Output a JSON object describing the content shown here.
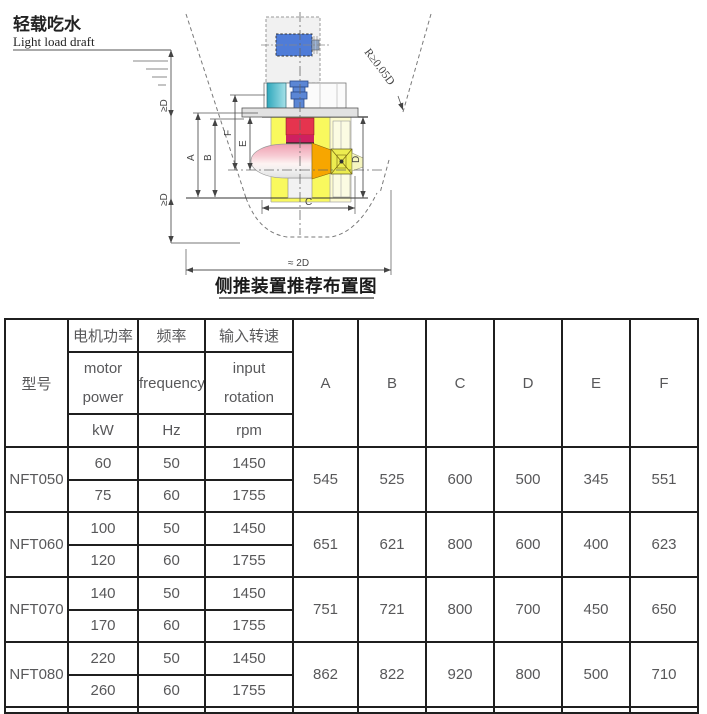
{
  "diagram": {
    "waterline_zh": "轻载吃水",
    "waterline_en": "Light load draft",
    "ge_d": "≥D",
    "approx_2d": "≈ 2D",
    "radius_note": "R≥0.05D",
    "dim_labels": [
      "A",
      "B",
      "C",
      "D",
      "E",
      "F"
    ],
    "caption": "侧推装置推荐布置图",
    "colors": {
      "tunnel_yellow": "#f9f95e",
      "tunnel_pale_yellow": "#fdfbd0",
      "motor_blue": "#4f7cd8",
      "coupling_blue": "#5b86d5",
      "coupling_cyan": "#3fb4c4",
      "gearbox_red": "#e5344e",
      "gearbox_crimson": "#cf2060",
      "pod_pink": "#ef9fb2",
      "cone_orange": "#f7a600",
      "hub_yellow": "#ecec50"
    }
  },
  "table": {
    "header": {
      "col_model": "型号",
      "groups": [
        {
          "zh": "电机功率",
          "en_lines": [
            "motor",
            "power"
          ],
          "unit": "kW"
        },
        {
          "zh": "频率",
          "en_lines": [
            "frequency",
            ""
          ],
          "unit": "Hz"
        },
        {
          "zh": "输入转速",
          "en_lines": [
            "input",
            "rotation"
          ],
          "unit": "rpm"
        }
      ],
      "dim_cols": [
        "A",
        "B",
        "C",
        "D",
        "E",
        "F"
      ]
    },
    "rows": [
      {
        "model": "NFT050",
        "variants": [
          [
            60,
            50,
            1450
          ],
          [
            75,
            60,
            1755
          ]
        ],
        "dims": [
          545,
          525,
          600,
          500,
          345,
          551
        ]
      },
      {
        "model": "NFT060",
        "variants": [
          [
            100,
            50,
            1450
          ],
          [
            120,
            60,
            1755
          ]
        ],
        "dims": [
          651,
          621,
          800,
          600,
          400,
          623
        ]
      },
      {
        "model": "NFT070",
        "variants": [
          [
            140,
            50,
            1450
          ],
          [
            170,
            60,
            1755
          ]
        ],
        "dims": [
          751,
          721,
          800,
          700,
          450,
          650
        ]
      },
      {
        "model": "NFT080",
        "variants": [
          [
            220,
            50,
            1450
          ],
          [
            260,
            60,
            1755
          ]
        ],
        "dims": [
          862,
          822,
          920,
          800,
          500,
          710
        ]
      }
    ]
  }
}
